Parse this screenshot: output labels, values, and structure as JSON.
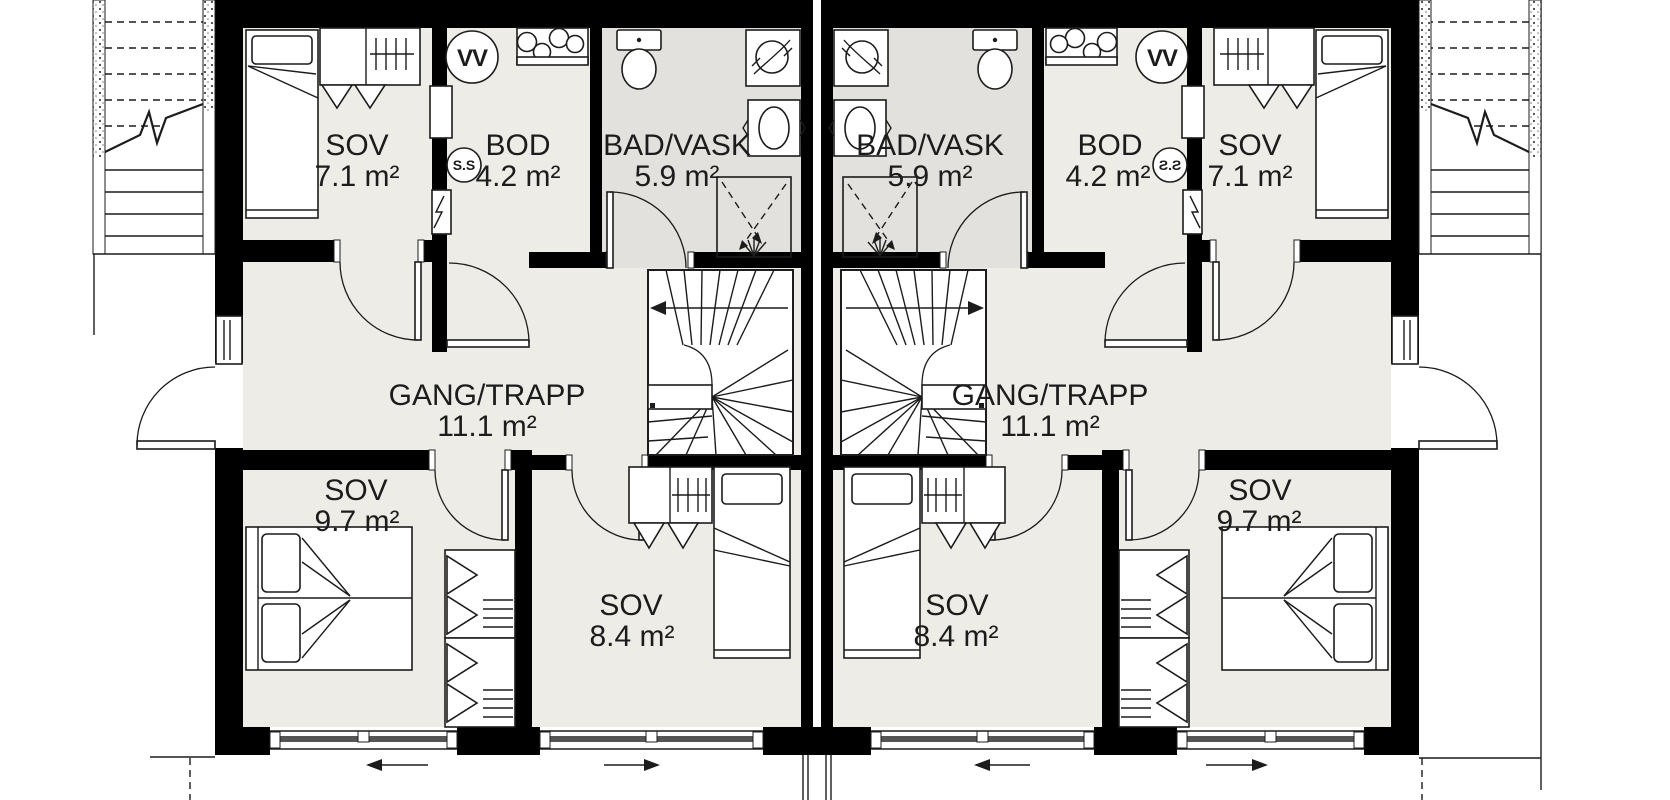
{
  "title": "Duplex upper floor plan",
  "units": {
    "left": {
      "sov_top": {
        "name": "SOV",
        "area": "7.1 m²"
      },
      "bod": {
        "name": "BOD",
        "area": "4.2 m²"
      },
      "bad": {
        "name": "BAD/VASK",
        "area": "5.9 m²"
      },
      "gang": {
        "name": "GANG/TRAPP",
        "area": "11.1 m²"
      },
      "sov_bottom_large": {
        "name": "SOV",
        "area": "9.7 m²"
      },
      "sov_bottom_small": {
        "name": "SOV",
        "area": "8.4 m²"
      },
      "water_heater_symbol": "VV",
      "fuse_box_symbol": "S.S"
    },
    "right": {
      "sov_top": {
        "name": "SOV",
        "area": "7.1 m²"
      },
      "bod": {
        "name": "BOD",
        "area": "4.2 m²"
      },
      "bad": {
        "name": "BAD/VASK",
        "area": "5.9 m²"
      },
      "gang": {
        "name": "GANG/TRAPP",
        "area": "11.1 m²"
      },
      "sov_bottom_large": {
        "name": "SOV",
        "area": "9.7 m²"
      },
      "sov_bottom_small": {
        "name": "SOV",
        "area": "8.4 m²"
      },
      "water_heater_symbol": "VV",
      "fuse_box_symbol": "S.S"
    }
  },
  "colors": {
    "wall": "#000000",
    "floor": "#edece7",
    "bath_floor": "#e2e1dd",
    "line": "#1c1c1c",
    "background": "#ffffff"
  }
}
